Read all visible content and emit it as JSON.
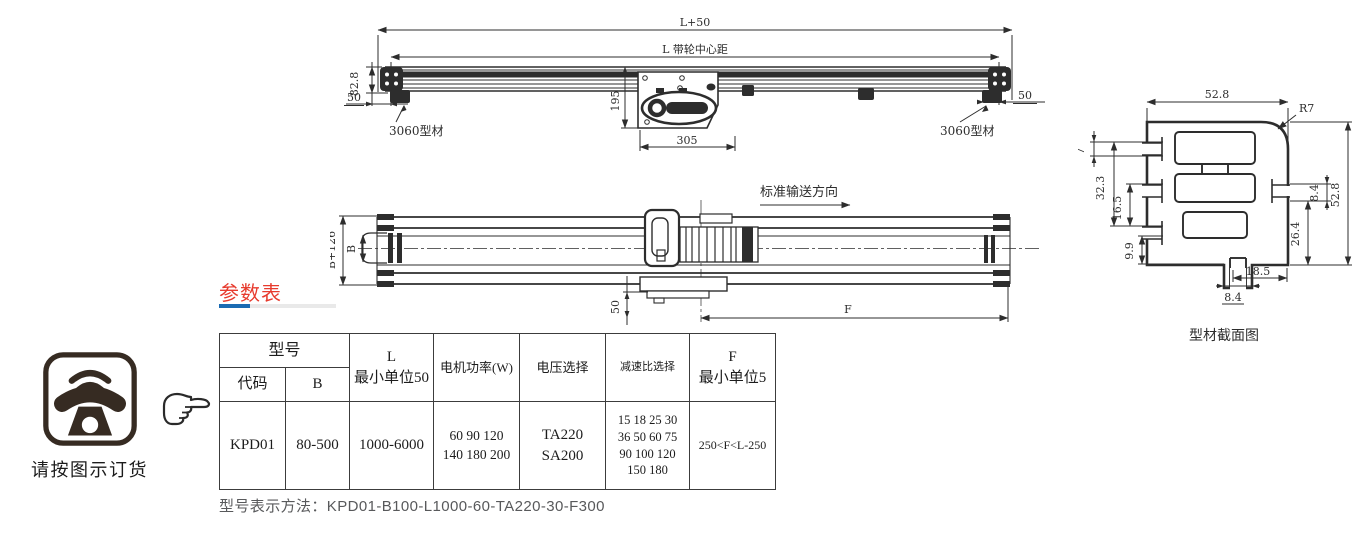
{
  "front_view": {
    "dim_total": "L+50",
    "dim_center": "L 带轮中心距",
    "dim_height": "82.8",
    "dim_offset_left": "50",
    "dim_motor_h": "195",
    "dim_motor_w": "305",
    "dim_offset_right": "50",
    "label_profile_left": "3060型材",
    "label_profile_right": "3060型材"
  },
  "plan_view": {
    "direction": "标准输送方向",
    "dim_overall": "B+126",
    "dim_belt": "B",
    "dim_50": "50",
    "dim_f": "F"
  },
  "section_view": {
    "caption": "型材截面图",
    "dim_top": "52.8",
    "dim_r": "R7",
    "dim_7": "7",
    "dim_323": "32.3",
    "dim_165": "16.5",
    "dim_99": "9.9",
    "dim_84r": "8.4",
    "dim_264": "26.4",
    "dim_right": "52.8",
    "dim_185": "18.5",
    "dim_84b": "8.4"
  },
  "params": {
    "title": "参数表",
    "headers": {
      "model": "型号",
      "code": "代码",
      "b": "B",
      "l": "L\n最小单位50",
      "power": "电机功率(W)",
      "voltage": "电压选择",
      "ratio": "减速比选择",
      "f": "F\n最小单位5"
    },
    "row": {
      "code": "KPD01",
      "b": "80-500",
      "l": "1000-6000",
      "power": "60 90 120\n140 180 200",
      "voltage": "TA220\nSA200",
      "ratio": "15 18 25 30\n36 50 60 75\n90 100 120\n150 180",
      "f": "250<F<L-250"
    },
    "note": "型号表示方法：KPD01-B100-L1000-60-TA220-30-F300"
  },
  "order": {
    "caption": "请按图示订货"
  },
  "colors": {
    "red": "#e73b2e",
    "blue": "#1a6bb3",
    "bar_gray": "#e9e9e9",
    "line": "#2d2d2d",
    "note_gray": "#58595b",
    "icon_dark": "#362b22"
  }
}
